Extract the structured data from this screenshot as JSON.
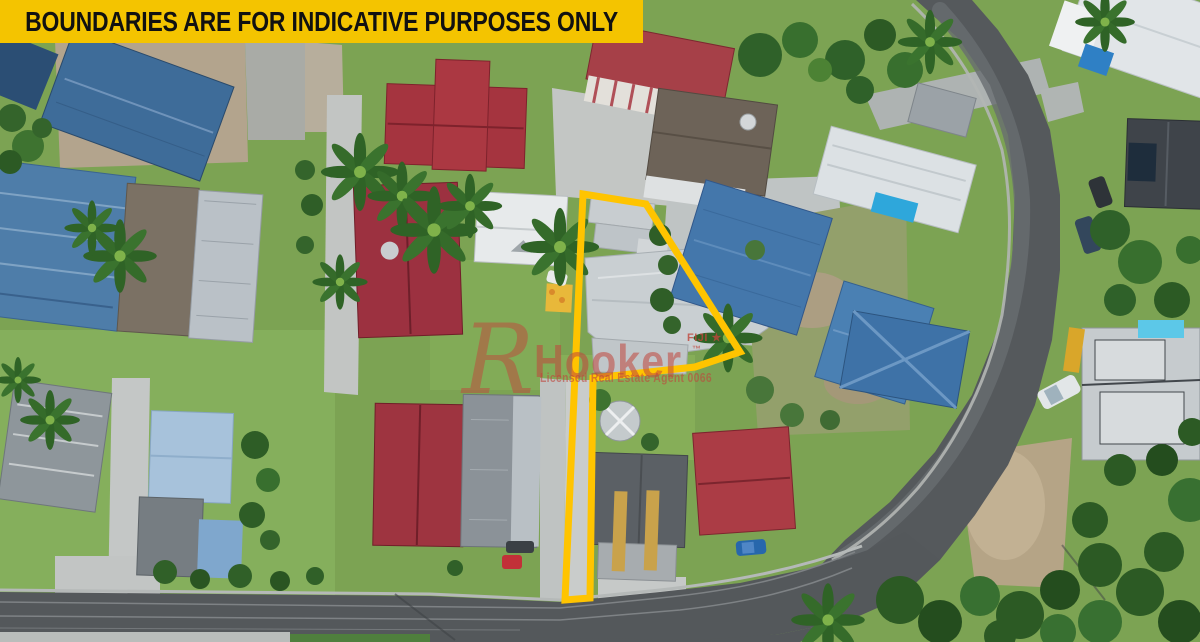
{
  "banner": {
    "text": "BOUNDARIES ARE FOR INDICATIVE PURPOSES ONLY",
    "background_color": "#F4C400",
    "text_color": "#111111"
  },
  "watermark": {
    "logo_letter": "R",
    "brand": "Hooker",
    "region": "FIJI ★",
    "trademark": "™",
    "license": "Licensed Real Estate Agent 0066",
    "color": "#C0463C"
  },
  "boundary": {
    "color": "#FFC400",
    "stroke_width": 7,
    "points": "583,194 646,204 740,352 695,367 593,378 590,598 565,600"
  },
  "palette": {
    "grass": "#7CA353",
    "asphalt": "#55595C",
    "concrete": "#C3C6C4",
    "roof_blue": "#4477AB",
    "roof_red": "#A5343F",
    "roof_white": "#E1E5E8",
    "roof_dark_gray": "#5B6065",
    "boundary_yellow": "#FFC400",
    "banner_yellow": "#F4C400"
  }
}
